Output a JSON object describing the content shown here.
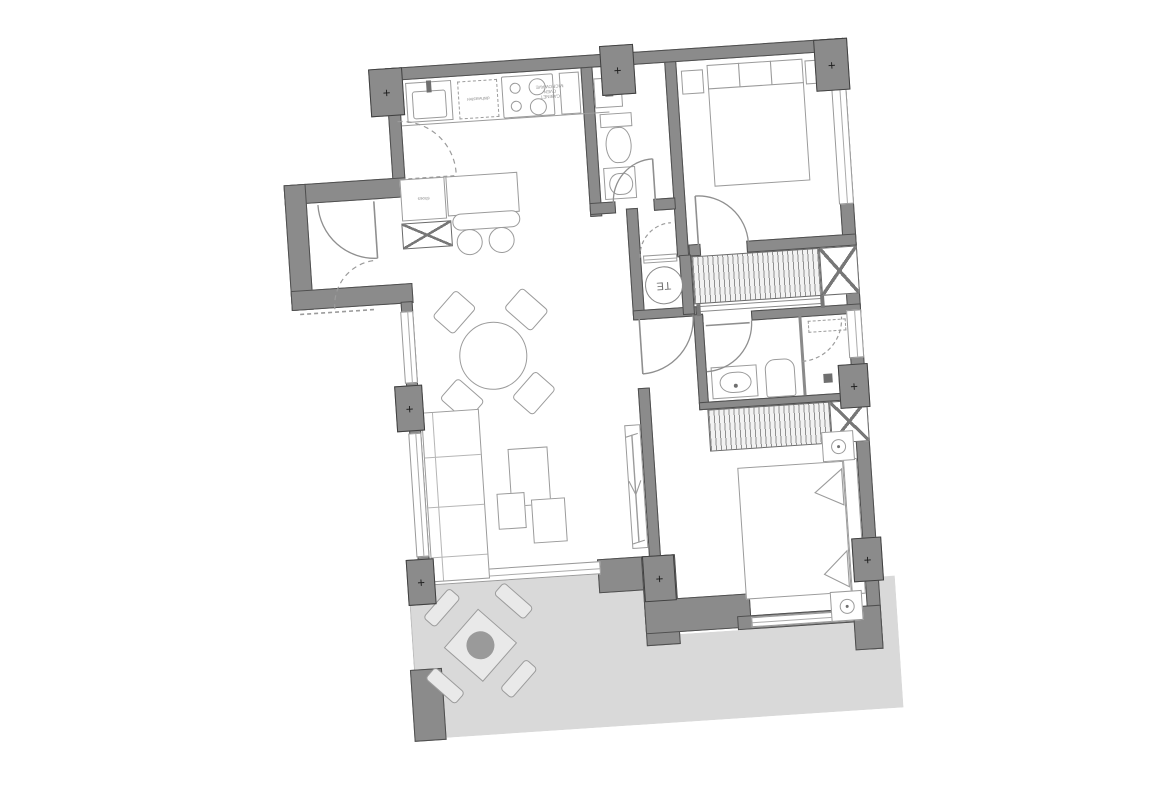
{
  "plan": {
    "type": "apartment-floor-plan",
    "rotation_deg": -3.8,
    "labels": {
      "utility_circle": "TE",
      "kitchen_counter_unit": "dishwasher",
      "kitchen_tall_unit_lines": [
        "MICROWAVE",
        "OVEN",
        "CABINET"
      ],
      "entry_cabinet": "shoes"
    },
    "markers": {
      "column_cross": "+"
    },
    "colors": {
      "wall_fill": "#8b8b8b",
      "wall_outline": "#4e4e4e",
      "terrace_fill": "#d9d9d9",
      "furniture_line": "#9b9b9b",
      "background": "#ffffff"
    }
  }
}
